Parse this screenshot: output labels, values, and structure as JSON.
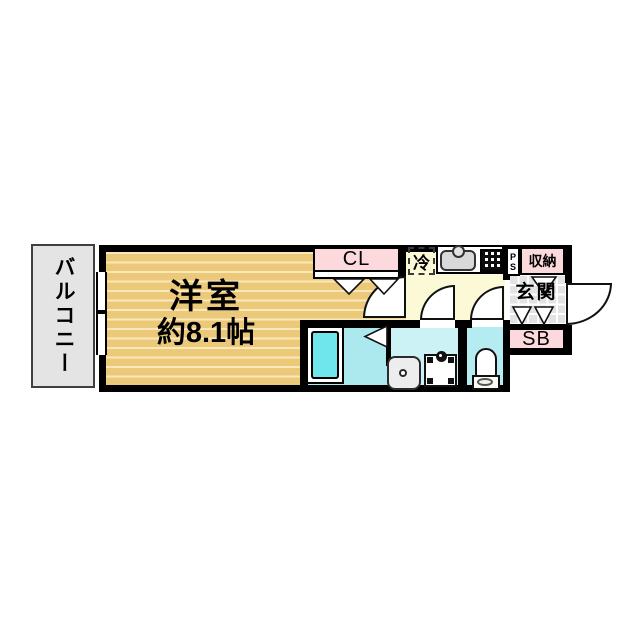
{
  "colors": {
    "wall": "#000000",
    "room_floor": "#ecc879",
    "room_stripe": "#f8e8bc",
    "balcony_bg": "#e4e4e4",
    "pink": "#fbd9dd",
    "kitchen_yellow": "#fcfad6",
    "bath_cyan": "#ace9ef",
    "bathtub_cyan": "#6fe6ec",
    "washroom_cyan": "#ccf2f6",
    "toilet_cyan": "#b5ecf1",
    "tile_gray": "#e3e3e3"
  },
  "plan": {
    "balcony": {
      "label": "バルコニー"
    },
    "room": {
      "name": "洋室",
      "size": "約8.1帖"
    },
    "closet": {
      "label": "CL"
    },
    "kitchen": {
      "fridge_label": "冷"
    },
    "pipe_space": {
      "line1": "P",
      "line2": "S"
    },
    "storage": {
      "label": "収納"
    },
    "entrance": {
      "label": "玄関"
    },
    "shoe_box": {
      "label": "SB"
    }
  }
}
